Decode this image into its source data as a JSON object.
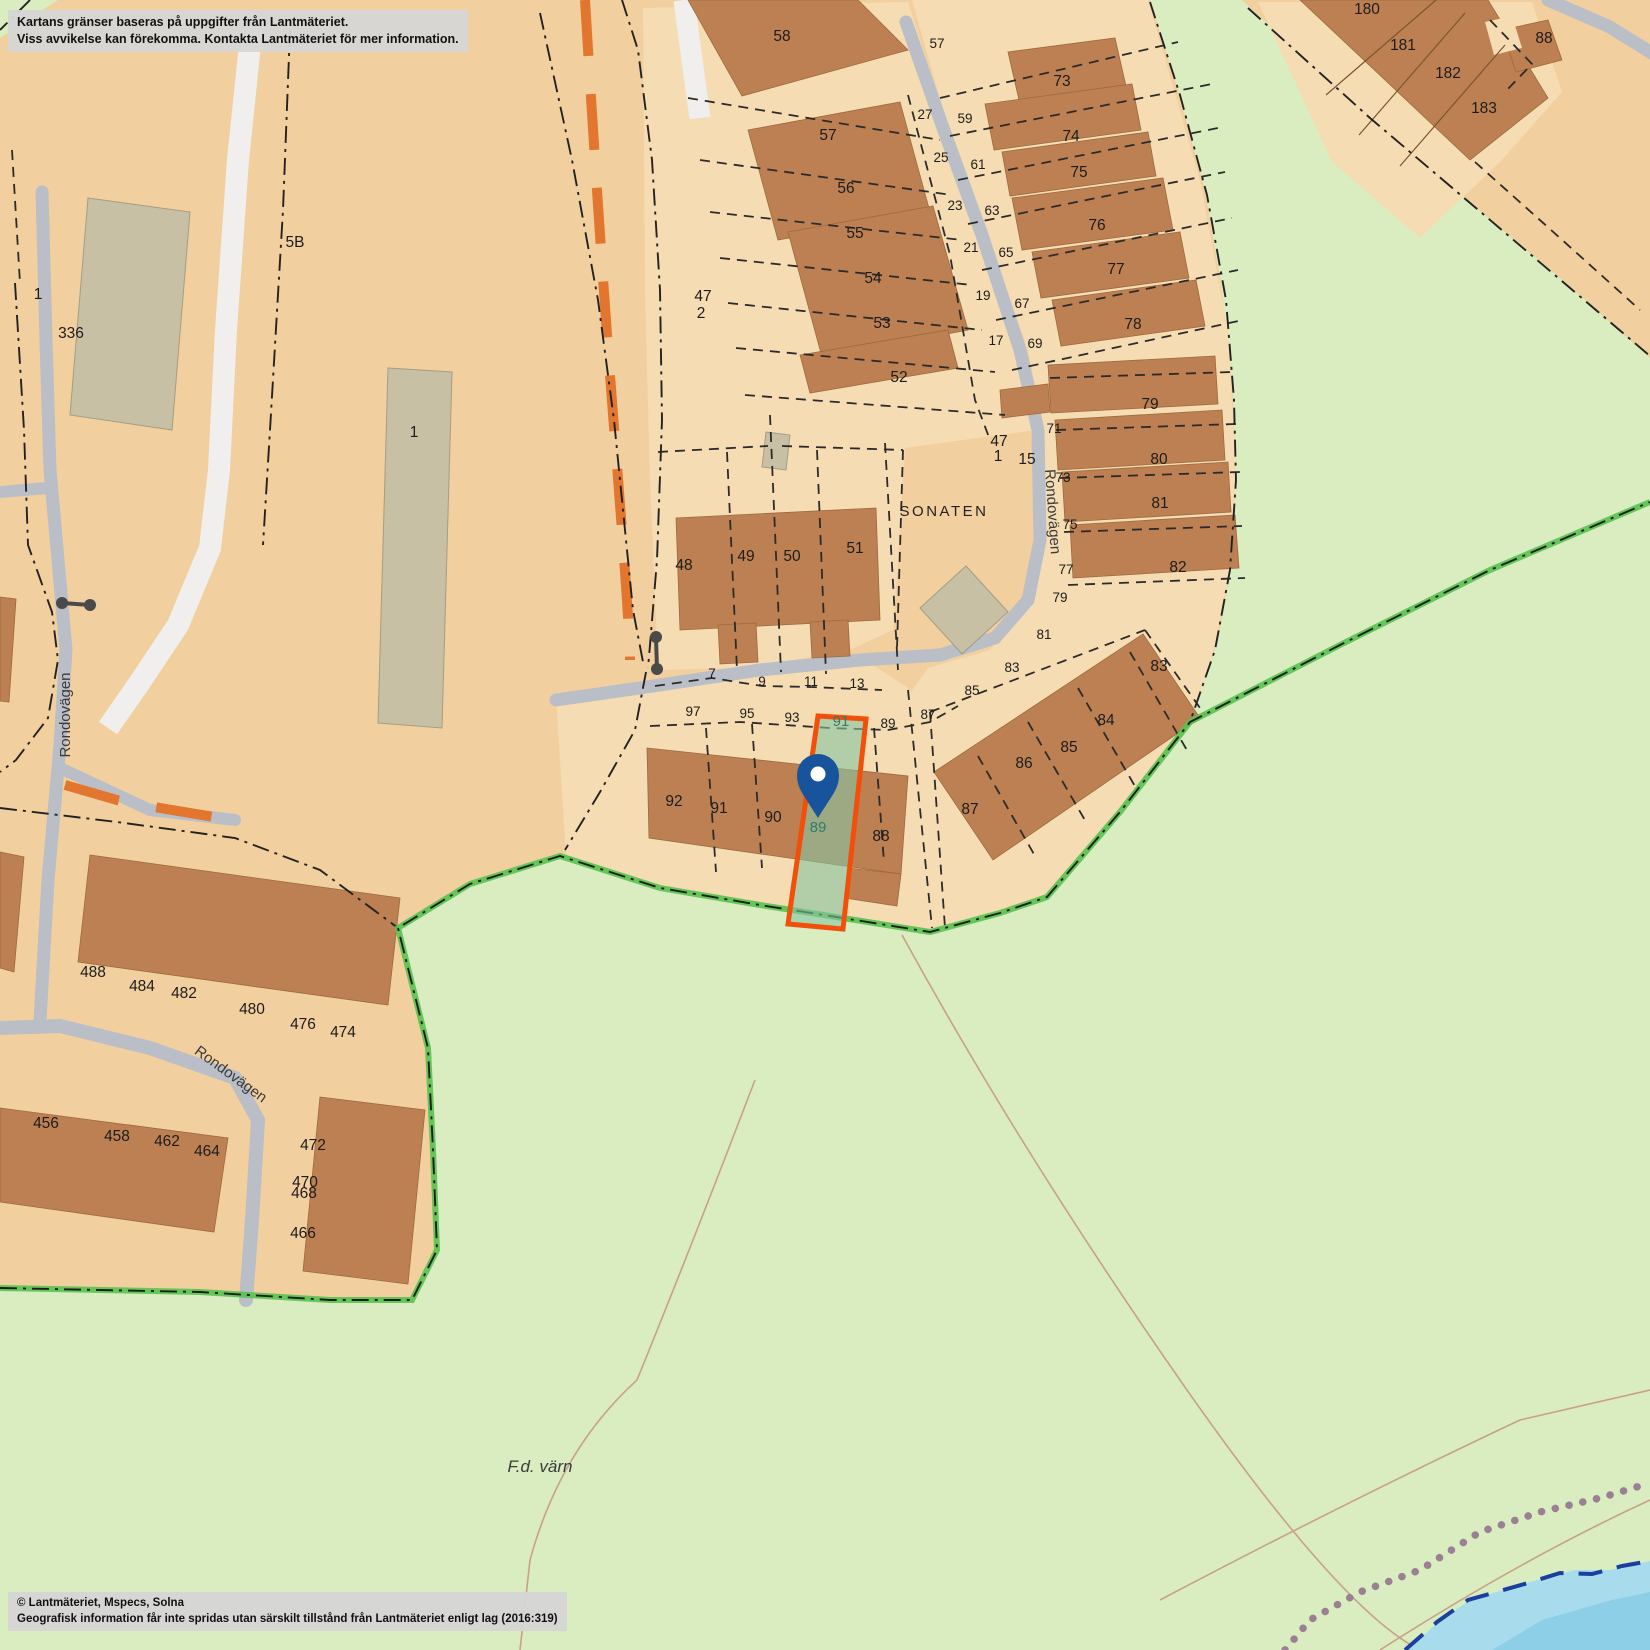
{
  "disclaimer": {
    "line1": "Kartans gränser baseras på uppgifter från Lantmäteriet.",
    "line2": "Viss avvikelse kan förekomma. Kontakta Lantmäteriet för mer information."
  },
  "copyright": {
    "line1": "© Lantmäteriet, Mspecs, Solna",
    "line2": "Geografisk information får inte spridas utan särskilt tillstånd från Lantmäteriet enligt lag (2016:319)"
  },
  "map": {
    "colors": {
      "background_tan": "#f2cf9e",
      "parcel_light": "#f6dcb2",
      "building_brown": "#bd8052",
      "building_khaki": "#c7c0a4",
      "green_area": "#d9edc1",
      "green_boundary": "#58c24e",
      "road_gray": "#b9bec7",
      "road_white": "#f0efed",
      "water": "#a8dced",
      "water_border": "#1c3f9f",
      "trail_dots": "#9b7f92",
      "contour": "#c9a184",
      "path_orange": "#e2762e",
      "highlight_stroke": "#f2500a",
      "highlight_fill": "rgba(134,196,164,0.6)",
      "pin_blue": "#17549c",
      "teal_label": "#2e7d6d"
    },
    "highlight": {
      "parcel": "89",
      "stroke": "#f2500a",
      "labels": [
        {
          "t": "89",
          "x": 818,
          "y": 832
        },
        {
          "t": "91",
          "x": 841,
          "y": 726
        }
      ]
    },
    "pin": {
      "color": "#17549c"
    },
    "street_labels": [
      {
        "t": "Rondovägen",
        "x": 70,
        "y": 715,
        "rot": -90,
        "cls": ""
      },
      {
        "t": "Rondovägen",
        "x": 1048,
        "y": 512,
        "rot": 86,
        "cls": ""
      },
      {
        "t": "Rondovägen",
        "x": 228,
        "y": 1078,
        "rot": 36,
        "cls": ""
      },
      {
        "t": "SONATEN",
        "x": 944,
        "y": 516,
        "rot": 0,
        "cls": "district"
      },
      {
        "t": "F.d. värn",
        "x": 540,
        "y": 1472,
        "rot": 0,
        "cls": "area"
      }
    ],
    "parcel_labels": [
      {
        "t": "58",
        "x": 782,
        "y": 41
      },
      {
        "t": "57",
        "x": 828,
        "y": 140
      },
      {
        "t": "56",
        "x": 846,
        "y": 193
      },
      {
        "t": "55",
        "x": 855,
        "y": 238
      },
      {
        "t": "54",
        "x": 873,
        "y": 283
      },
      {
        "t": "53",
        "x": 882,
        "y": 328
      },
      {
        "t": "52",
        "x": 899,
        "y": 382
      },
      {
        "t": "47",
        "x": 703,
        "y": 301
      },
      {
        "t": "2",
        "x": 701,
        "y": 318
      },
      {
        "t": "48",
        "x": 684,
        "y": 570
      },
      {
        "t": "49",
        "x": 746,
        "y": 561
      },
      {
        "t": "50",
        "x": 792,
        "y": 561
      },
      {
        "t": "51",
        "x": 855,
        "y": 553
      },
      {
        "t": "73",
        "x": 1062,
        "y": 86
      },
      {
        "t": "74",
        "x": 1071,
        "y": 141
      },
      {
        "t": "75",
        "x": 1079,
        "y": 177
      },
      {
        "t": "76",
        "x": 1097,
        "y": 230
      },
      {
        "t": "77",
        "x": 1116,
        "y": 274
      },
      {
        "t": "78",
        "x": 1133,
        "y": 329
      },
      {
        "t": "79",
        "x": 1150,
        "y": 409
      },
      {
        "t": "80",
        "x": 1159,
        "y": 464
      },
      {
        "t": "81",
        "x": 1160,
        "y": 508
      },
      {
        "t": "82",
        "x": 1178,
        "y": 572
      },
      {
        "t": "83",
        "x": 1159,
        "y": 671
      },
      {
        "t": "84",
        "x": 1106,
        "y": 725
      },
      {
        "t": "85",
        "x": 1069,
        "y": 752
      },
      {
        "t": "86",
        "x": 1024,
        "y": 768
      },
      {
        "t": "87",
        "x": 970,
        "y": 814
      },
      {
        "t": "88",
        "x": 881,
        "y": 841
      },
      {
        "t": "90",
        "x": 773,
        "y": 822
      },
      {
        "t": "91",
        "x": 719,
        "y": 813
      },
      {
        "t": "92",
        "x": 674,
        "y": 806
      },
      {
        "t": "180",
        "x": 1367,
        "y": 14
      },
      {
        "t": "181",
        "x": 1403,
        "y": 50
      },
      {
        "t": "182",
        "x": 1448,
        "y": 78
      },
      {
        "t": "183",
        "x": 1484,
        "y": 113
      },
      {
        "t": "88",
        "x": 1544,
        "y": 43
      },
      {
        "t": "336",
        "x": 71,
        "y": 338
      },
      {
        "t": "1",
        "x": 38,
        "y": 299
      },
      {
        "t": "5B",
        "x": 295,
        "y": 247
      },
      {
        "t": "1",
        "x": 414,
        "y": 437
      },
      {
        "t": "47",
        "x": 999,
        "y": 446
      },
      {
        "t": "1",
        "x": 998,
        "y": 461
      },
      {
        "t": "15",
        "x": 1027,
        "y": 464
      },
      {
        "t": "488",
        "x": 93,
        "y": 977
      },
      {
        "t": "484",
        "x": 142,
        "y": 991
      },
      {
        "t": "482",
        "x": 184,
        "y": 998
      },
      {
        "t": "480",
        "x": 252,
        "y": 1014
      },
      {
        "t": "476",
        "x": 303,
        "y": 1029
      },
      {
        "t": "474",
        "x": 343,
        "y": 1037
      },
      {
        "t": "456",
        "x": 46,
        "y": 1128
      },
      {
        "t": "458",
        "x": 117,
        "y": 1141
      },
      {
        "t": "462",
        "x": 167,
        "y": 1146
      },
      {
        "t": "464",
        "x": 207,
        "y": 1156
      },
      {
        "t": "472",
        "x": 313,
        "y": 1150
      },
      {
        "t": "470",
        "x": 305,
        "y": 1187
      },
      {
        "t": "468",
        "x": 304,
        "y": 1198
      },
      {
        "t": "466",
        "x": 303,
        "y": 1238
      }
    ],
    "road_numbers": [
      {
        "t": "57",
        "x": 937,
        "y": 48
      },
      {
        "t": "27",
        "x": 925,
        "y": 119
      },
      {
        "t": "25",
        "x": 941,
        "y": 162
      },
      {
        "t": "23",
        "x": 955,
        "y": 210
      },
      {
        "t": "21",
        "x": 971,
        "y": 252
      },
      {
        "t": "19",
        "x": 983,
        "y": 300
      },
      {
        "t": "17",
        "x": 996,
        "y": 345
      },
      {
        "t": "59",
        "x": 965,
        "y": 123
      },
      {
        "t": "61",
        "x": 978,
        "y": 169
      },
      {
        "t": "63",
        "x": 992,
        "y": 215
      },
      {
        "t": "65",
        "x": 1006,
        "y": 257
      },
      {
        "t": "67",
        "x": 1022,
        "y": 308
      },
      {
        "t": "69",
        "x": 1035,
        "y": 348
      },
      {
        "t": "71",
        "x": 1054,
        "y": 433
      },
      {
        "t": "73",
        "x": 1063,
        "y": 482
      },
      {
        "t": "75",
        "x": 1070,
        "y": 529
      },
      {
        "t": "77",
        "x": 1066,
        "y": 574
      },
      {
        "t": "79",
        "x": 1060,
        "y": 602
      },
      {
        "t": "81",
        "x": 1044,
        "y": 639
      },
      {
        "t": "83",
        "x": 1012,
        "y": 672
      },
      {
        "t": "85",
        "x": 972,
        "y": 695
      },
      {
        "t": "87",
        "x": 928,
        "y": 719
      },
      {
        "t": "89",
        "x": 888,
        "y": 728
      },
      {
        "t": "7",
        "x": 712,
        "y": 678
      },
      {
        "t": "9",
        "x": 762,
        "y": 686
      },
      {
        "t": "11",
        "x": 811,
        "y": 686
      },
      {
        "t": "13",
        "x": 857,
        "y": 688
      },
      {
        "t": "97",
        "x": 693,
        "y": 716
      },
      {
        "t": "95",
        "x": 747,
        "y": 718
      },
      {
        "t": "93",
        "x": 792,
        "y": 722
      }
    ]
  }
}
